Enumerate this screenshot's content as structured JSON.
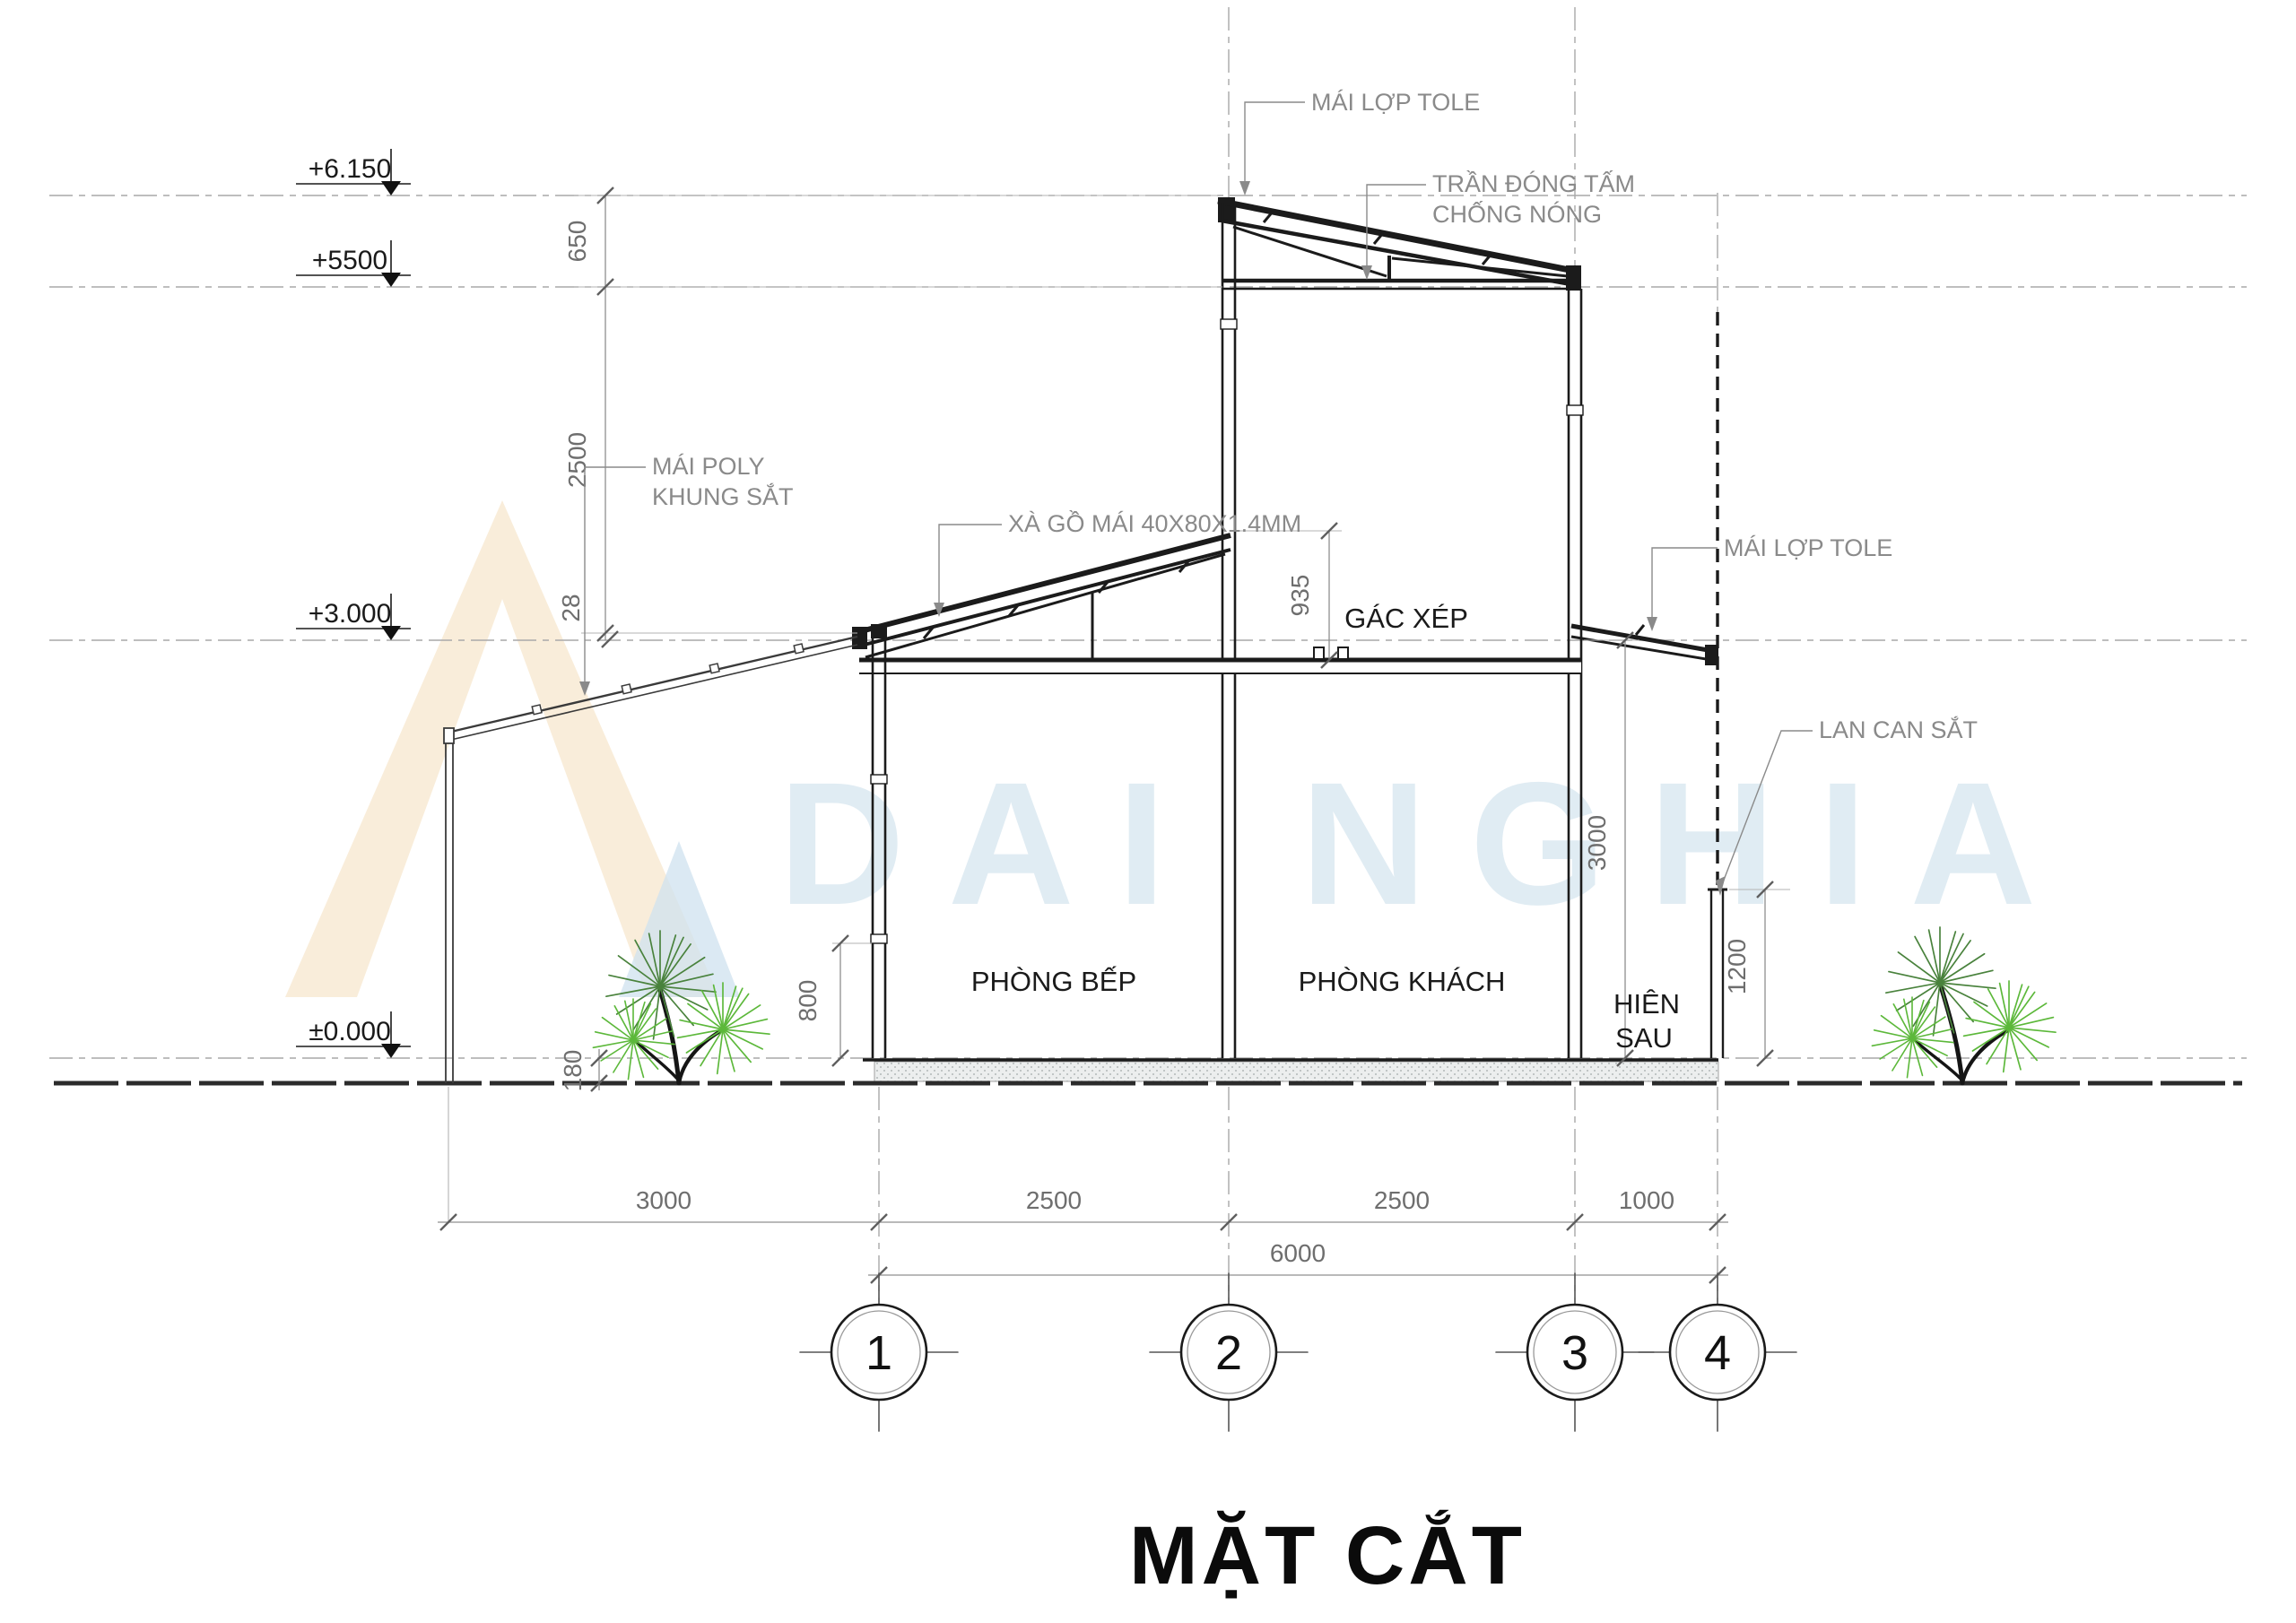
{
  "title": "MẶT CẮT",
  "watermark": {
    "text": "DAI NGHIA"
  },
  "colors": {
    "tree_bright": "#5cb83a",
    "tree_dark": "#49823c",
    "watermark_orange": "#f9edda",
    "watermark_blue": "#cfe2ef",
    "annotation_gray": "#8a8a8a"
  },
  "elevations": {
    "top": "+6.150",
    "upper": "+5500",
    "mid": "+3.000",
    "ground": "±0.000"
  },
  "left_dims": {
    "d650": "650",
    "d2500": "2500",
    "d28": "28"
  },
  "inner_dims": {
    "d935": "935",
    "d800": "800",
    "d180": "180"
  },
  "right_dims": {
    "d3000": "3000",
    "d1200": "1200"
  },
  "annotations": {
    "roof_tole_top": "MÁI LỢP TOLE",
    "ceiling_line1": "TRẦN ĐÓNG TẤM",
    "ceiling_line2": "CHỐNG NÓNG",
    "poly_line1": "MÁI POLY",
    "poly_line2": "KHUNG SẮT",
    "purlin": "XÀ GỒ MÁI 40X80X1.4MM",
    "roof_tole_right": "MÁI LỢP TOLE",
    "railing": "LAN CAN SẮT"
  },
  "rooms": {
    "kitchen": "PHÒNG BẾP",
    "living": "PHÒNG KHÁCH",
    "loft": "GÁC XÉP",
    "porch_line1": "HIÊN",
    "porch_line2": "SAU"
  },
  "bottom_dims": {
    "seg1": "3000",
    "seg2": "2500",
    "seg3": "2500",
    "seg4": "1000",
    "total": "6000"
  },
  "bubbles": {
    "b1": "1",
    "b2": "2",
    "b3": "3",
    "b4": "4"
  }
}
